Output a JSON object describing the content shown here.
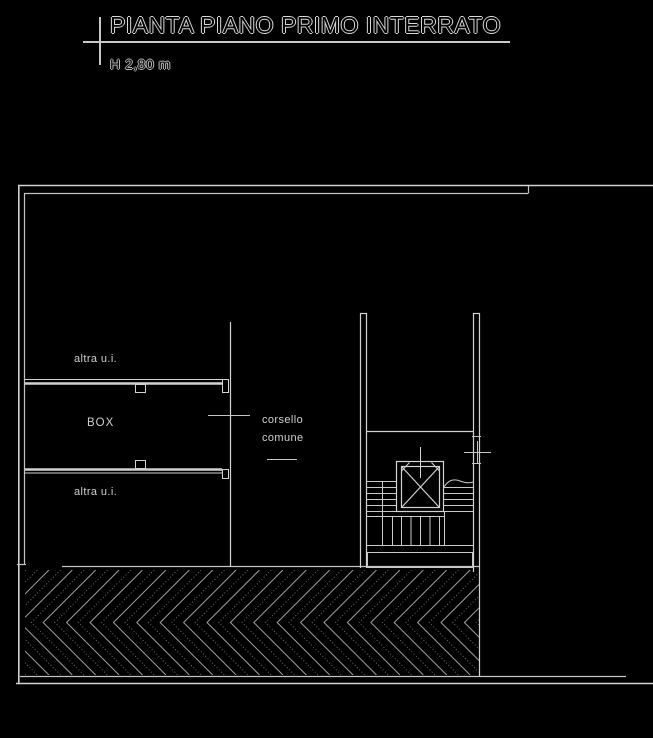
{
  "header": {
    "title": "PIANTA PIANO PRIMO INTERRATO",
    "height_label": "H 2,80 m"
  },
  "plan": {
    "room_labels": {
      "altra_ui_top": "altra u.i.",
      "box": "BOX",
      "altra_ui_bottom": "altra u.i.",
      "corsello_line1": "corsello",
      "corsello_line2": "comune"
    }
  },
  "colors": {
    "background": "#000000",
    "line": "#d2d2d2",
    "hatch_solid": "#a0a0a0",
    "hatch_dotted": "#6e6e6e",
    "text": "#cfcfcf"
  }
}
